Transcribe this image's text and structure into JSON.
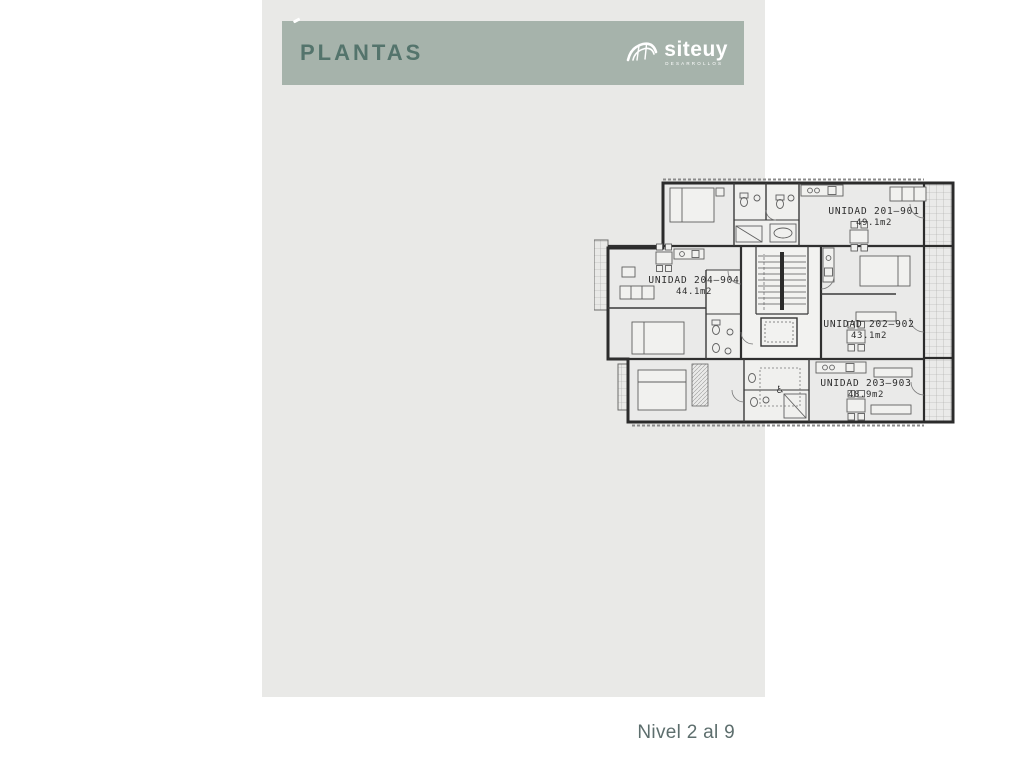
{
  "header": {
    "title": "PLANTAS",
    "logo": {
      "wordmark": "siteuy",
      "tagline": "DESARROLLOS"
    }
  },
  "plan": {
    "units": [
      {
        "name": "UNIDAD 201–901",
        "area": "49.1m2"
      },
      {
        "name": "UNIDAD 204–904",
        "area": "44.1m2"
      },
      {
        "name": "UNIDAD 202–902",
        "area": "43.1m2"
      },
      {
        "name": "UNIDAD 203–903",
        "area": "48.9m2"
      }
    ],
    "accessible_icon": "♿"
  },
  "footer": {
    "level": "Nivel 2 al 9"
  },
  "colors": {
    "page_background": "#ffffff",
    "panel_background": "#e9e9e7",
    "header_bar": "#a6b3ab",
    "header_title": "#54746c",
    "logo_text": "#ffffff",
    "footer_text": "#5d6e6d",
    "plan_lines": "#2f2f2f"
  }
}
